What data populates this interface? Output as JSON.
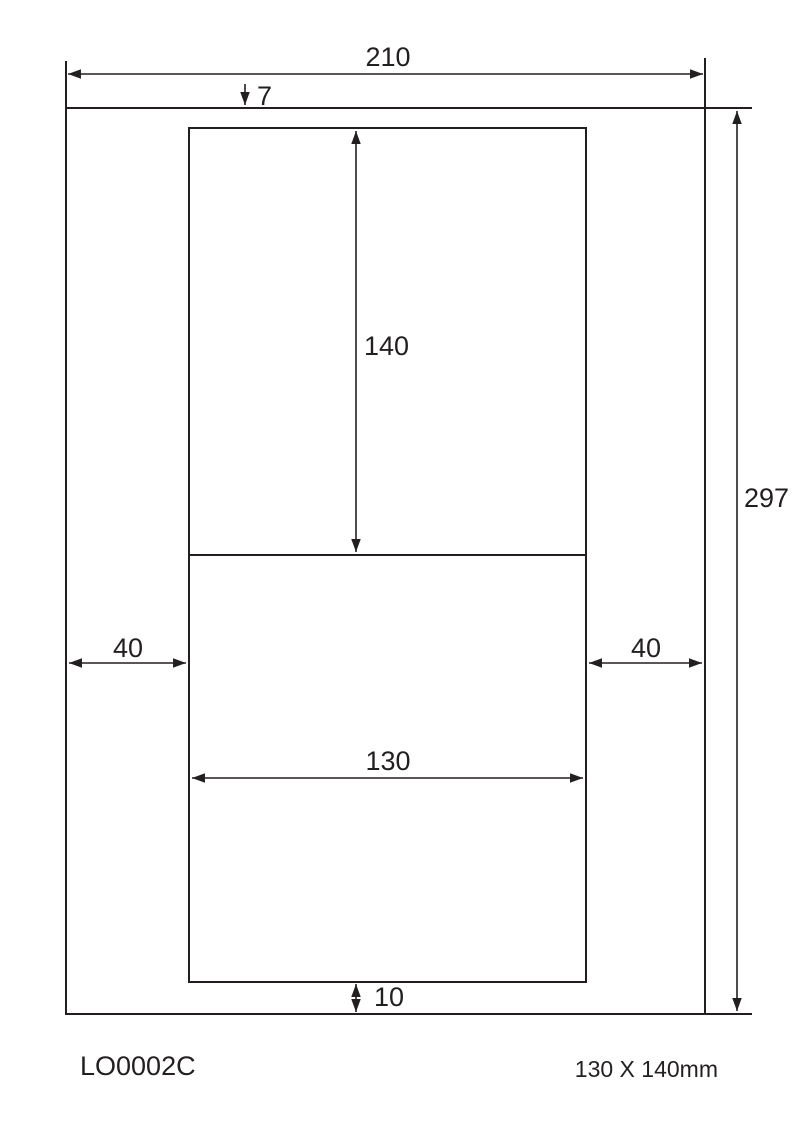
{
  "diagram": {
    "product_code": "LO0002C",
    "label_size_text": "130 X 140mm",
    "ink_color": "#231f20",
    "dimensions": {
      "page_width_mm": "210",
      "page_height_mm": "297",
      "top_margin_mm": "7",
      "bottom_margin_mm": "10",
      "left_margin_mm": "40",
      "right_margin_mm": "40",
      "label_width_mm": "130",
      "label_height_mm": "140"
    }
  }
}
